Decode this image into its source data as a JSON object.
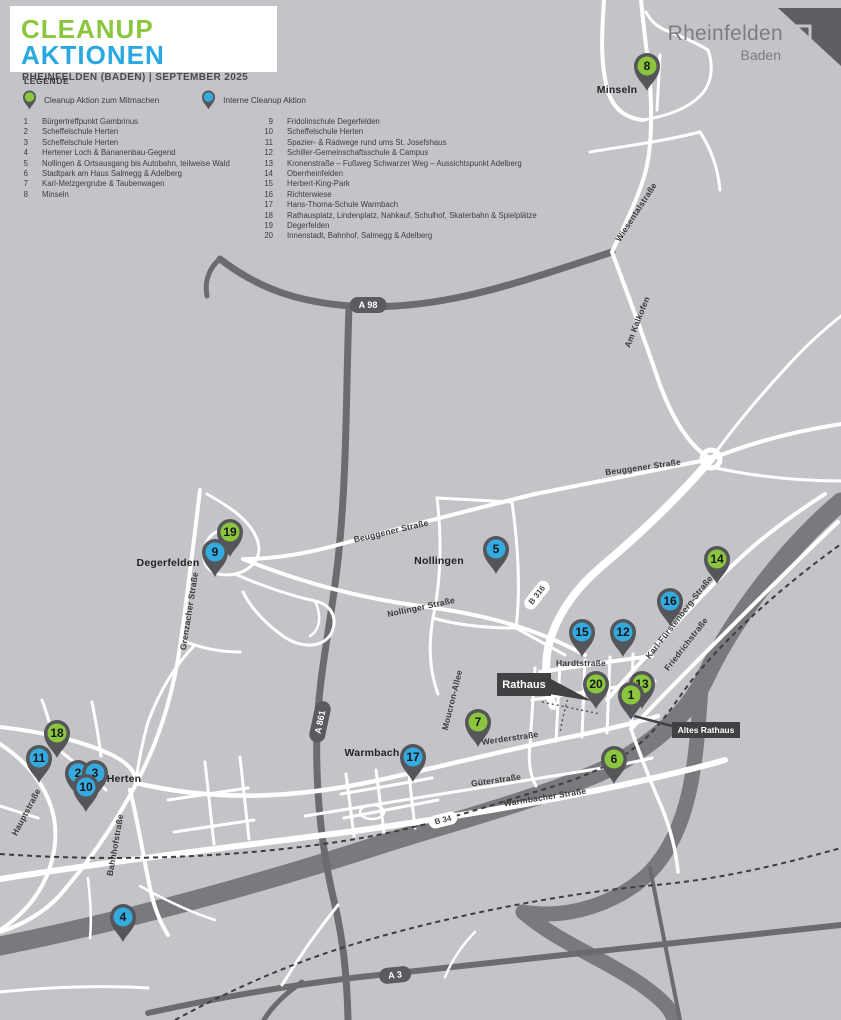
{
  "header": {
    "title_green": "CLEANUP",
    "title_blue": "AKTIONEN",
    "subtitle": "RHEINFELDEN (BADEN) | SEPTEMBER 2025"
  },
  "logo": {
    "name": "Rheinfelden",
    "sub": "Baden"
  },
  "legend": {
    "heading": "LEGENDE",
    "items": [
      {
        "type": "green",
        "label": "Cleanup Aktion zum Mitmachen"
      },
      {
        "type": "blue",
        "label": "Interne Cleanup Aktion"
      }
    ]
  },
  "locations": {
    "left": [
      {
        "n": "1",
        "name": "Bürgertreffpunkt Gambrinus"
      },
      {
        "n": "2",
        "name": "Scheffelschule Herten"
      },
      {
        "n": "3",
        "name": "Scheffelschule Herten"
      },
      {
        "n": "4",
        "name": "Hertener Loch & Bananenbau-Gegend"
      },
      {
        "n": "5",
        "name": "Nollingen & Ortsausgang bis Autobahn, teilweise Wald"
      },
      {
        "n": "6",
        "name": "Stadtpark am Haus Salmegg & Adelberg"
      },
      {
        "n": "7",
        "name": "Karl-Metzgergrube & Taubenwagen"
      },
      {
        "n": "8",
        "name": "Minseln"
      }
    ],
    "right": [
      {
        "n": "9",
        "name": "Fridolinschule Degerfelden"
      },
      {
        "n": "10",
        "name": "Scheffelschule Herten"
      },
      {
        "n": "11",
        "name": "Spazier- & Radwege rund ums St. Josefshaus"
      },
      {
        "n": "12",
        "name": "Schiller-Gemeinschaftsschule & Campus"
      },
      {
        "n": "13",
        "name": "Kronenstraße – Fußweg Schwarzer Weg – Aussichtspunkt Adelberg"
      },
      {
        "n": "14",
        "name": "Oberrheinfelden"
      },
      {
        "n": "15",
        "name": "Herbert-King-Park"
      },
      {
        "n": "16",
        "name": "Richterwiese"
      },
      {
        "n": "17",
        "name": "Hans-Thoma-Schule Warmbach"
      },
      {
        "n": "18",
        "name": "Rathausplatz, Lindenplatz, Nahkauf, Schulhof, Skaterbahn & Spielplätze"
      },
      {
        "n": "19",
        "name": "Degerfelden"
      },
      {
        "n": "20",
        "name": "Innenstadt, Bahnhof, Salmegg & Adelberg"
      }
    ]
  },
  "map": {
    "colors": {
      "background": "#c4c4c8",
      "road_white": "#ffffff",
      "motorway": "#6c6c70",
      "river": "#7a7a7e",
      "pin_body": "#55565a",
      "pin_green": "#8cc63e",
      "pin_blue": "#35aadf",
      "title_green": "#8cc63e",
      "title_blue": "#2aa9e0"
    },
    "place_labels": [
      {
        "text": "Minseln",
        "x": 617,
        "y": 90
      },
      {
        "text": "Degerfelden",
        "x": 168,
        "y": 563
      },
      {
        "text": "Nollingen",
        "x": 439,
        "y": 561
      },
      {
        "text": "Herten",
        "x": 124,
        "y": 779
      },
      {
        "text": "Warmbach",
        "x": 372,
        "y": 753
      }
    ],
    "street_labels": [
      {
        "text": "Wiesentalstraße",
        "x": 636,
        "y": 212,
        "rot": -57
      },
      {
        "text": "Am Kalkofen",
        "x": 637,
        "y": 322,
        "rot": -68
      },
      {
        "text": "Beuggener Straße",
        "x": 643,
        "y": 467,
        "rot": -8
      },
      {
        "text": "Beuggener Straße",
        "x": 391,
        "y": 531,
        "rot": -13
      },
      {
        "text": "Nollinger Straße",
        "x": 421,
        "y": 607,
        "rot": -12
      },
      {
        "text": "Grenzacher Straße",
        "x": 189,
        "y": 611,
        "rot": -81
      },
      {
        "text": "Karl-Fürstenberg-Straße",
        "x": 679,
        "y": 617,
        "rot": -52
      },
      {
        "text": "Friedrichstraße",
        "x": 686,
        "y": 644,
        "rot": -52
      },
      {
        "text": "Hardtstraße",
        "x": 581,
        "y": 663,
        "rot": 0
      },
      {
        "text": "Moucron-Allee",
        "x": 452,
        "y": 700,
        "rot": -76
      },
      {
        "text": "Werderstraße",
        "x": 510,
        "y": 738,
        "rot": -8
      },
      {
        "text": "Güterstraße",
        "x": 496,
        "y": 780,
        "rot": -8
      },
      {
        "text": "Warmbacher Straße",
        "x": 545,
        "y": 797,
        "rot": -9
      },
      {
        "text": "Hauptstraße",
        "x": 26,
        "y": 812,
        "rot": -62
      },
      {
        "text": "Bahnhofstraße",
        "x": 115,
        "y": 845,
        "rot": -80
      }
    ],
    "badges": [
      {
        "text": "A 98",
        "x": 368,
        "y": 305,
        "rot": 0,
        "style": "dark"
      },
      {
        "text": "A 861",
        "x": 320,
        "y": 722,
        "rot": -78,
        "style": "dark"
      },
      {
        "text": "A 3",
        "x": 395,
        "y": 975,
        "rot": -6,
        "style": "dark"
      },
      {
        "text": "B 316",
        "x": 537,
        "y": 595,
        "rot": -52,
        "style": "light"
      },
      {
        "text": "B 34",
        "x": 443,
        "y": 820,
        "rot": -14,
        "style": "light"
      }
    ],
    "callouts": [
      {
        "text": "Rathaus",
        "x": 497,
        "y": 673,
        "w": 54,
        "h": 23,
        "size": 11
      },
      {
        "text": "Altes Rathaus",
        "x": 672,
        "y": 722,
        "w": 68,
        "h": 16,
        "size": 8.5
      }
    ],
    "pins": [
      {
        "n": "8",
        "type": "green",
        "x": 647,
        "y": 66
      },
      {
        "n": "19",
        "type": "green",
        "x": 230,
        "y": 532
      },
      {
        "n": "9",
        "type": "blue",
        "x": 215,
        "y": 552
      },
      {
        "n": "5",
        "type": "blue",
        "x": 496,
        "y": 549
      },
      {
        "n": "14",
        "type": "green",
        "x": 717,
        "y": 559
      },
      {
        "n": "16",
        "type": "blue",
        "x": 670,
        "y": 601
      },
      {
        "n": "15",
        "type": "blue",
        "x": 582,
        "y": 632
      },
      {
        "n": "12",
        "type": "blue",
        "x": 623,
        "y": 632
      },
      {
        "n": "20",
        "type": "green",
        "x": 596,
        "y": 684
      },
      {
        "n": "13",
        "type": "green",
        "x": 642,
        "y": 684
      },
      {
        "n": "1",
        "type": "green",
        "x": 631,
        "y": 695
      },
      {
        "n": "7",
        "type": "green",
        "x": 478,
        "y": 722
      },
      {
        "n": "17",
        "type": "blue",
        "x": 413,
        "y": 757
      },
      {
        "n": "6",
        "type": "green",
        "x": 614,
        "y": 759
      },
      {
        "n": "18",
        "type": "green",
        "x": 57,
        "y": 733
      },
      {
        "n": "11",
        "type": "blue",
        "x": 39,
        "y": 758
      },
      {
        "n": "2",
        "type": "blue",
        "x": 78,
        "y": 773
      },
      {
        "n": "3",
        "type": "blue",
        "x": 95,
        "y": 773
      },
      {
        "n": "10",
        "type": "blue",
        "x": 86,
        "y": 787
      },
      {
        "n": "4",
        "type": "blue",
        "x": 123,
        "y": 917
      }
    ]
  }
}
